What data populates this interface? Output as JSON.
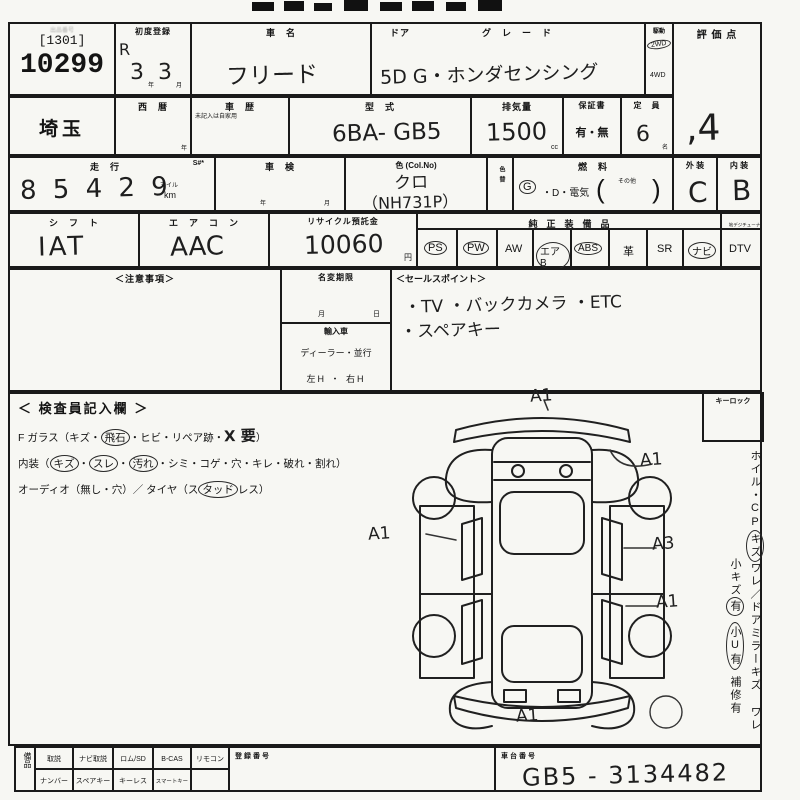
{
  "lot": {
    "faint_label": "出品番号",
    "tag": "[1301]",
    "number": "10299"
  },
  "first_reg": {
    "label": "初度登録",
    "era": "R",
    "year": "3",
    "year_unit": "年",
    "month": "3",
    "month_unit": "月"
  },
  "car_name": {
    "label": "車　名",
    "value": "フリード"
  },
  "door_grade": {
    "door_label": "ドア",
    "grade_label": "グ　レ　ー　ド",
    "value": "5D G・ホンダセンシング"
  },
  "drive": {
    "label": "駆動",
    "option1": "2WD",
    "option2": "4WD"
  },
  "score": {
    "label": "評 価 点",
    "value": ",4"
  },
  "region": {
    "value": "埼玉"
  },
  "seireki": {
    "label": "西　暦",
    "unit": "年"
  },
  "shareki": {
    "label": "車　歴",
    "note": "未記入は自家用"
  },
  "model": {
    "label": "型　式",
    "value": "6BA- GB5"
  },
  "displacement": {
    "label": "排気量",
    "value": "1500",
    "unit": "cc"
  },
  "warranty": {
    "label": "保証書",
    "options": "有・無"
  },
  "capacity": {
    "label": "定　員",
    "value": "6",
    "unit": "名"
  },
  "mileage": {
    "label": "走　行",
    "s_label": "S#*",
    "value": "8 5 4 2 9",
    "unit1": "マイル",
    "unit2": "km"
  },
  "shaken": {
    "label": "車　検",
    "year_unit": "年",
    "month_unit": "月"
  },
  "color": {
    "label": "色 (Col.No)",
    "value": "クロ",
    "code": "（NH731P）"
  },
  "color_change": {
    "label": "色替"
  },
  "fuel": {
    "label": "燃　料",
    "g": "G",
    "mid": "・D・電気",
    "open": "(",
    "other": "その他",
    "close": ")"
  },
  "exterior": {
    "label": "外 装",
    "value": "C"
  },
  "interior": {
    "label": "内 装",
    "value": "B"
  },
  "shift": {
    "label": "シ　フ　ト",
    "value": "IAT"
  },
  "aircon": {
    "label": "エ　ア　コ　ン",
    "value": "AAC"
  },
  "recycle": {
    "label": "リサイクル預託金",
    "value": "10060",
    "unit": "円"
  },
  "equipment": {
    "header": "純　正　装　備　品",
    "tuner_header": "地デジチューナー有",
    "items": [
      {
        "label": "PS",
        "circled": true
      },
      {
        "label": "PW",
        "circled": true
      },
      {
        "label": "AW",
        "circled": false
      },
      {
        "label": "エアB",
        "circled": true
      },
      {
        "label": "ABS",
        "circled": true
      },
      {
        "label": "革",
        "circled": false
      },
      {
        "label": "SR",
        "circled": false
      },
      {
        "label": "ナビ",
        "circled": true
      },
      {
        "label": "DTV",
        "circled": false
      }
    ]
  },
  "notes": {
    "label": "＜注意事項＞"
  },
  "name_change": {
    "label": "名変期限",
    "month_unit": "月",
    "day_unit": "日"
  },
  "import_car": {
    "label": "輸入車",
    "line1": "ディーラー・並行",
    "line2": "左H ・ 右H"
  },
  "sales_points": {
    "label": "＜セールスポイント＞",
    "line1": "・TV ・バックカメラ ・ETC",
    "line2": "・スペアキー"
  },
  "inspector": {
    "header": "＜ 検査員記入欄 ＞",
    "l1a": "F ガラス（キズ・",
    "l1b": "飛石",
    "l1c": "・ヒビ・リペア跡・",
    "l1hand": "X 要",
    "l1close": "）",
    "l2a": "内装（",
    "l2b": "キズ",
    "l2c": "・",
    "l2d": "スレ",
    "l2e": "・",
    "l2f": "汚れ",
    "l2g": "・シミ・コゲ・穴・キレ・破れ・割れ）",
    "l3a": "オーディオ（無し・穴）／ タイヤ（ス",
    "l3b": "タッド",
    "l3c": "レス）"
  },
  "keylock": {
    "label": "キーロック"
  },
  "side_notes": {
    "col1a": "ホイル・CP",
    "col1b": "キズ",
    "col1c": "ワレ／ドアミラー",
    "col1d": "キズ ワレ",
    "col2a": "小キズ",
    "col2b": "有",
    "col2c": "小U有",
    "col2d": "補修有"
  },
  "diagram": {
    "marks": [
      {
        "text": "A1"
      },
      {
        "text": "A1"
      },
      {
        "text": "A1"
      },
      {
        "text": "A3"
      },
      {
        "text": "A1"
      },
      {
        "text": "A1"
      }
    ]
  },
  "bottom": {
    "side_label": "備品",
    "row1": [
      "取説",
      "ナビ取説",
      "ロム/SD",
      "B-CAS",
      "リモコン"
    ],
    "row2": [
      "ナンバー",
      "スペアキー",
      "キーレス",
      "スマートキー",
      ""
    ],
    "reg_label": "登録番号",
    "chassis_label": "車台番号",
    "chassis_value": "GB5 - 3134482"
  }
}
